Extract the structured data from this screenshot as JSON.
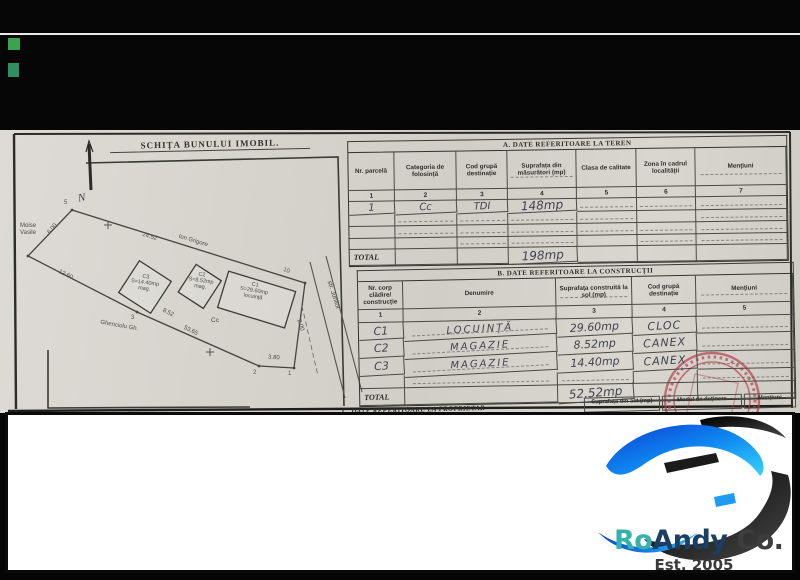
{
  "colors": {
    "paper": "#d6d3cd",
    "band": "#060606",
    "square_green_1": "#3ba34f",
    "square_green_2": "#2e8f5f",
    "stamp_red": "#b54452",
    "logo_blue": "#1e9bf5",
    "logo_dark": "#1b1b1b",
    "logo_teal": "#34b2ad"
  },
  "sketch": {
    "title": "SCHIȚA BUNULUI IMOBIL.",
    "north": "N",
    "neighbor_left": "Moise\nVasile",
    "neighbor_top": "Ion Grigore",
    "neighbor_bottom": "Ghenciolu Gh.",
    "street": "str. Junilor",
    "land_code": "Cc",
    "dims": {
      "d600": "6.00",
      "d2452": "24.52",
      "d1260": "12.60",
      "d852": "8.52",
      "d5365": "53.65",
      "d380": "3.80",
      "d200": "2.00"
    },
    "points": {
      "p5": "5",
      "p3": "3",
      "p2": "2",
      "p1": "1",
      "p10": "10"
    },
    "buildings": {
      "c3": "C3\nS=14.40mp\nmag.",
      "c2": "C2\nS=8.52mp\nmag.",
      "c1": "C1\nS=29.60mp\nlocuință"
    }
  },
  "table_a": {
    "title": "A. DATE REFERITOARE LA TEREN",
    "headers": [
      "Nr. parcelă",
      "Categoria de folosință",
      "Cod grupă destinație",
      "Suprafața din măsurători (mp)",
      "Clasa de calitate",
      "Zona în cadrul localității",
      "Mențiuni"
    ],
    "nums": [
      "1",
      "2",
      "3",
      "4",
      "5",
      "6",
      "7"
    ],
    "row": {
      "nr": "1",
      "categoria": "Cc",
      "cod": "TDI",
      "suprafata": "148mp"
    },
    "total_label": "TOTAL",
    "total_value": "198mp"
  },
  "table_b": {
    "title": "B. DATE REFERITOARE LA CONSTRUCȚII",
    "headers": [
      "Nr. corp clădire/ construcție",
      "Denumire",
      "Suprafața construită la sol (mp)",
      "Cod grupă destinație",
      "Mențiuni"
    ],
    "nums": [
      "1",
      "2",
      "3",
      "4",
      "5"
    ],
    "rows": [
      {
        "nr": "C1",
        "denumire": "LOCUINȚĂ",
        "suprafata": "29.60mp",
        "cod": "CLOC"
      },
      {
        "nr": "C2",
        "denumire": "MAGAZIE",
        "suprafata": "8.52mp",
        "cod": "CANEX"
      },
      {
        "nr": "C3",
        "denumire": "MAGAZIE",
        "suprafata": "14.40mp",
        "cod": "CANEX"
      }
    ],
    "total_label": "TOTAL",
    "total_value": "52.52mp"
  },
  "section_c": {
    "title": "C. DATE REFERITOARE LA PROPRIETAR",
    "headers": [
      "Suprafața din act (mp)",
      "Modul de deținere",
      "Mențiuni"
    ]
  },
  "logo": {
    "ro": "Ro",
    "andy": "Andy",
    "co": " Co.",
    "est": "Est. 2005"
  }
}
